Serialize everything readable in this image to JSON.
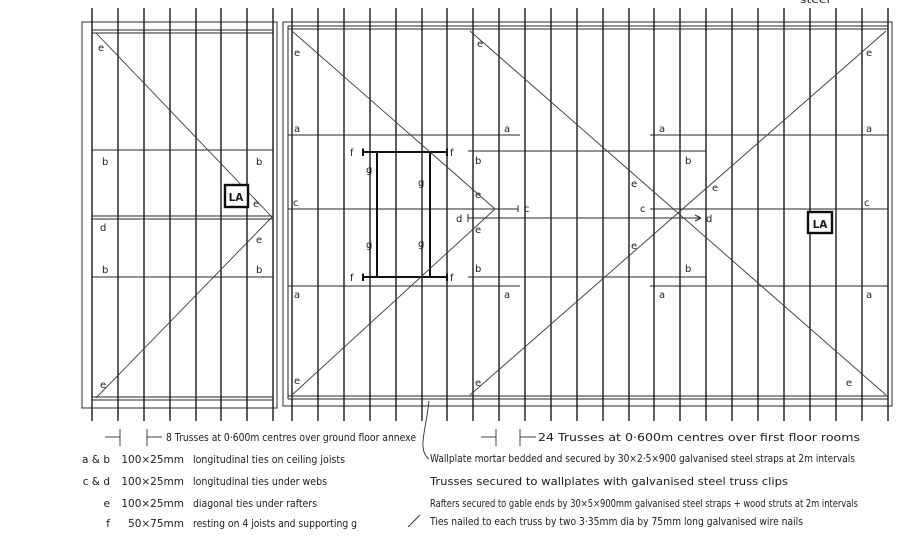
{
  "colors": {
    "ink": "#1c1c1c",
    "paper": "#ffffff"
  },
  "drawing": {
    "access_label": "LA",
    "top_cutoff_text": "steel",
    "left_caption": "8 Trusses at 0·600m centres over ground floor annexe",
    "right_caption": "24 Trusses at 0·600m centres over first floor rooms",
    "letter_labels": [
      {
        "t": "e",
        "x": 98,
        "y": 51
      },
      {
        "t": "b",
        "x": 102,
        "y": 165
      },
      {
        "t": "b",
        "x": 256,
        "y": 165
      },
      {
        "t": "d",
        "x": 100,
        "y": 231
      },
      {
        "t": "b",
        "x": 102,
        "y": 273
      },
      {
        "t": "b",
        "x": 256,
        "y": 273
      },
      {
        "t": "e",
        "x": 253,
        "y": 207
      },
      {
        "t": "e",
        "x": 256,
        "y": 243
      },
      {
        "t": "e",
        "x": 100,
        "y": 388
      },
      {
        "t": "e",
        "x": 294,
        "y": 56
      },
      {
        "t": "e",
        "x": 477,
        "y": 47
      },
      {
        "t": "a",
        "x": 294,
        "y": 132
      },
      {
        "t": "a",
        "x": 504,
        "y": 132
      },
      {
        "t": "a",
        "x": 659,
        "y": 132
      },
      {
        "t": "a",
        "x": 866,
        "y": 132
      },
      {
        "t": "f",
        "x": 350,
        "y": 156
      },
      {
        "t": "f",
        "x": 450,
        "y": 156
      },
      {
        "t": "g",
        "x": 366,
        "y": 173
      },
      {
        "t": "g",
        "x": 418,
        "y": 186
      },
      {
        "t": "b",
        "x": 475,
        "y": 164
      },
      {
        "t": "b",
        "x": 685,
        "y": 164
      },
      {
        "t": "c",
        "x": 293,
        "y": 206
      },
      {
        "t": "c",
        "x": 524,
        "y": 212
      },
      {
        "t": "c",
        "x": 640,
        "y": 212
      },
      {
        "t": "c",
        "x": 864,
        "y": 206
      },
      {
        "t": "d",
        "x": 456,
        "y": 222
      },
      {
        "t": "d",
        "x": 706,
        "y": 222
      },
      {
        "t": "e",
        "x": 475,
        "y": 198
      },
      {
        "t": "e",
        "x": 475,
        "y": 233
      },
      {
        "t": "e",
        "x": 631,
        "y": 187
      },
      {
        "t": "e",
        "x": 712,
        "y": 191
      },
      {
        "t": "e",
        "x": 631,
        "y": 249
      },
      {
        "t": "g",
        "x": 366,
        "y": 248
      },
      {
        "t": "g",
        "x": 418,
        "y": 247
      },
      {
        "t": "f",
        "x": 350,
        "y": 281
      },
      {
        "t": "f",
        "x": 450,
        "y": 281
      },
      {
        "t": "b",
        "x": 475,
        "y": 272
      },
      {
        "t": "b",
        "x": 685,
        "y": 272
      },
      {
        "t": "a",
        "x": 294,
        "y": 298
      },
      {
        "t": "a",
        "x": 504,
        "y": 298
      },
      {
        "t": "a",
        "x": 659,
        "y": 298
      },
      {
        "t": "a",
        "x": 866,
        "y": 298
      },
      {
        "t": "e",
        "x": 294,
        "y": 384
      },
      {
        "t": "e",
        "x": 475,
        "y": 386
      },
      {
        "t": "e",
        "x": 846,
        "y": 386
      },
      {
        "t": "e",
        "x": 866,
        "y": 56
      }
    ]
  },
  "legend": {
    "rows": [
      {
        "key": "a & b",
        "size": "100×25mm",
        "desc": "longitudinal ties on ceiling joists"
      },
      {
        "key": "c & d",
        "size": "100×25mm",
        "desc": "longitudinal ties under webs"
      },
      {
        "key": "e",
        "size": "100×25mm",
        "desc": "diagonal ties under rafters"
      },
      {
        "key": "f",
        "size": "50×75mm",
        "desc": "resting on 4 joists and supporting g"
      }
    ]
  },
  "notes": {
    "lines": [
      "Wallplate mortar bedded and secured by 30×2·5×900 galvanised steel straps at 2m intervals",
      "Trusses secured to wallplates with galvanised steel truss clips",
      "Rafters secured to gable ends by 30×5×900mm galvanised steel straps + wood struts at 2m intervals",
      "Ties nailed to each truss by two 3·35mm dia by 75mm long galvanised wire nails"
    ]
  }
}
